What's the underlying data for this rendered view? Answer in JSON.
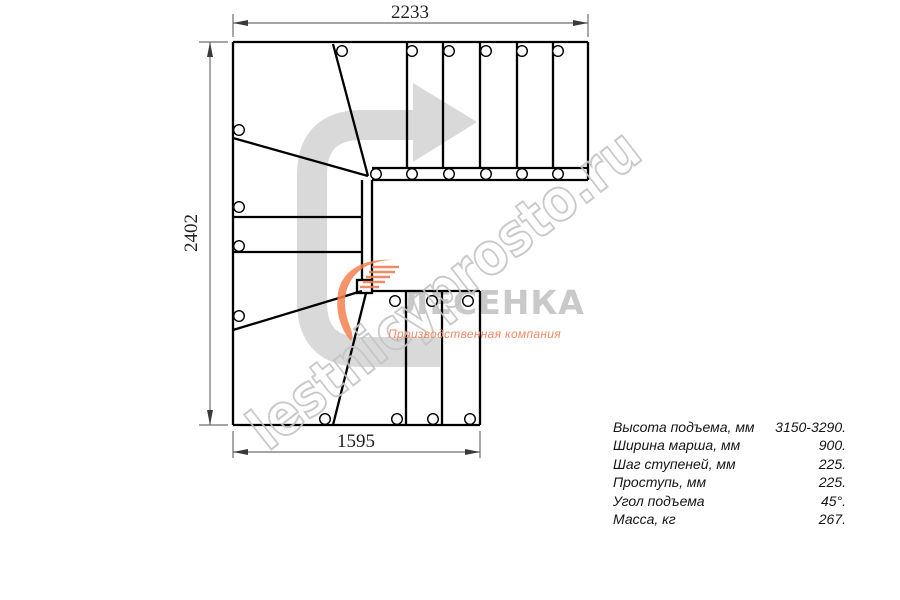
{
  "drawing": {
    "dim_top": "2233",
    "dim_left": "2402",
    "dim_bottom": "1595"
  },
  "watermark": {
    "text": "lestnicyprosto.ru"
  },
  "logo": {
    "name": "ЛЕСЕНКА",
    "subtitle": "Производственная компания"
  },
  "specs": {
    "rows": [
      {
        "label": "Высота подъема, мм",
        "value": "3150-3290."
      },
      {
        "label": "Ширина марша, мм",
        "value": "900."
      },
      {
        "label": "Шаг ступеней, мм",
        "value": "225."
      },
      {
        "label": "Проступь, мм",
        "value": "225."
      },
      {
        "label": "Угол подъема",
        "value": "45°."
      },
      {
        "label": "Масса, кг",
        "value": "267."
      }
    ]
  },
  "colors": {
    "stair_line": "#000000",
    "dimension_line": "#6f6f6f",
    "direction_arrow": "#d9d9d9",
    "watermark_stroke": "#c4c4c4",
    "logo_name_fill": "#c9c9c9",
    "logo_accent": "#f26a3a",
    "logo_subtitle_fill": "#ef8a66"
  }
}
